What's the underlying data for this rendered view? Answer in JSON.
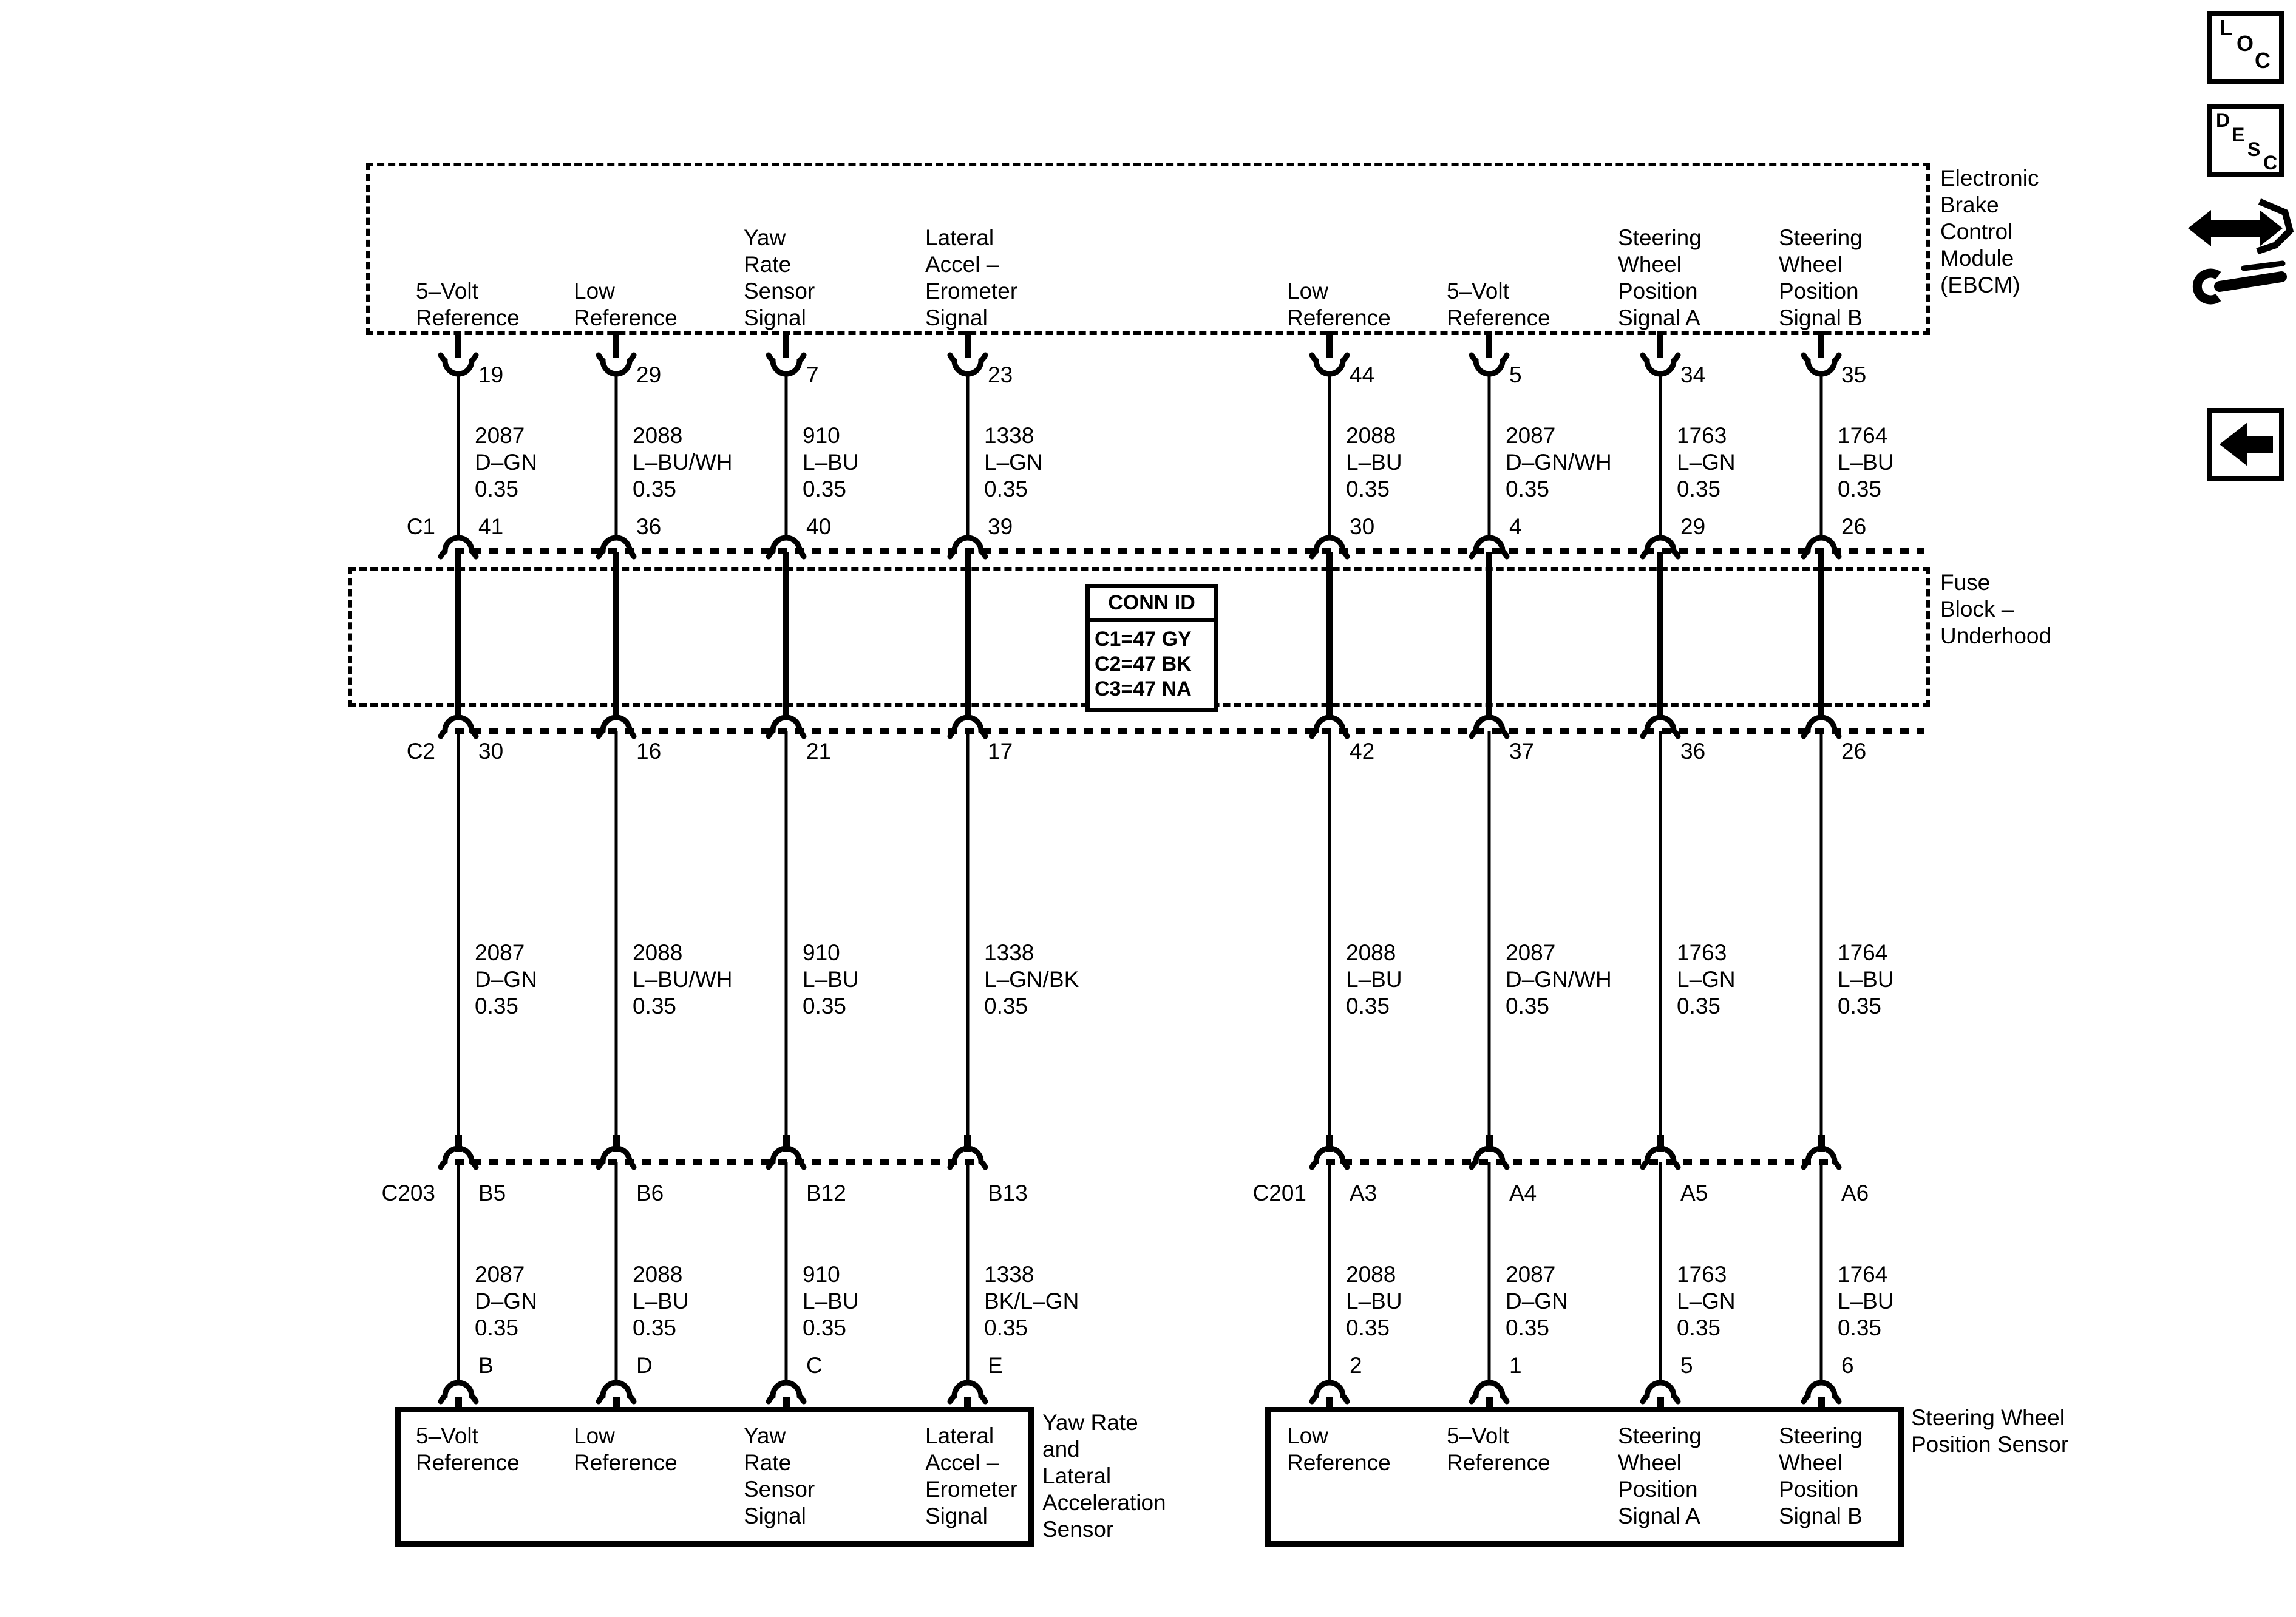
{
  "page": {
    "background": "#ffffff",
    "ink": "#000000"
  },
  "nav": {
    "loc_letters": [
      "L",
      "O",
      "C"
    ],
    "desc_letters": [
      "D",
      "E",
      "S",
      "C"
    ]
  },
  "ebcm": {
    "name": "Electronic\nBrake\nControl\nModule\n(EBCM)"
  },
  "fuse_block": {
    "name": "Fuse\nBlock –\nUnderhood",
    "conn_id_title": "CONN ID",
    "conn_id_rows": [
      "C1=47 GY",
      "C2=47 BK",
      "C3=47 NA"
    ]
  },
  "connectors": {
    "c1": "C1",
    "c2": "C2",
    "c203": "C203",
    "c201": "C201"
  },
  "sensors": {
    "yaw": "Yaw Rate\nand\nLateral\nAcceleration\nSensor",
    "swps": "Steering Wheel\nPosition Sensor"
  },
  "columns": [
    {
      "ebcm_signal": "5–Volt\nReference",
      "ebcm_pin": "19",
      "wire_top": "2087\nD–GN\n0.35",
      "c1_pin": "41",
      "c2_pin": "30",
      "wire_mid": "2087\nD–GN\n0.35",
      "branch_pin": "B5",
      "wire_bottom": "2087\nD–GN\n0.35",
      "device_pin": "B",
      "device_signal": "5–Volt\nReference"
    },
    {
      "ebcm_signal": "Low\nReference",
      "ebcm_pin": "29",
      "wire_top": "2088\nL–BU/WH\n0.35",
      "c1_pin": "36",
      "c2_pin": "16",
      "wire_mid": "2088\nL–BU/WH\n0.35",
      "branch_pin": "B6",
      "wire_bottom": "2088\nL–BU\n0.35",
      "device_pin": "D",
      "device_signal": "Low\nReference"
    },
    {
      "ebcm_signal": "Yaw\nRate\nSensor\nSignal",
      "ebcm_pin": "7",
      "wire_top": "910\nL–BU\n0.35",
      "c1_pin": "40",
      "c2_pin": "21",
      "wire_mid": "910\nL–BU\n0.35",
      "branch_pin": "B12",
      "wire_bottom": "910\nL–BU\n0.35",
      "device_pin": "C",
      "device_signal": "Yaw\nRate\nSensor\nSignal"
    },
    {
      "ebcm_signal": "Lateral\nAccel –\nErometer\nSignal",
      "ebcm_pin": "23",
      "wire_top": "1338\nL–GN\n0.35",
      "c1_pin": "39",
      "c2_pin": "17",
      "wire_mid": "1338\nL–GN/BK\n0.35",
      "branch_pin": "B13",
      "wire_bottom": "1338\nBK/L–GN\n0.35",
      "device_pin": "E",
      "device_signal": "Lateral\nAccel –\nErometer\nSignal"
    },
    {
      "ebcm_signal": "Low\nReference",
      "ebcm_pin": "44",
      "wire_top": "2088\nL–BU\n0.35",
      "c1_pin": "30",
      "c2_pin": "42",
      "wire_mid": "2088\nL–BU\n0.35",
      "branch_pin": "A3",
      "wire_bottom": "2088\nL–BU\n0.35",
      "device_pin": "2",
      "device_signal": "Low\nReference"
    },
    {
      "ebcm_signal": "5–Volt\nReference",
      "ebcm_pin": "5",
      "wire_top": "2087\nD–GN/WH\n0.35",
      "c1_pin": "4",
      "c2_pin": "37",
      "wire_mid": "2087\nD–GN/WH\n0.35",
      "branch_pin": "A4",
      "wire_bottom": "2087\nD–GN\n0.35",
      "device_pin": "1",
      "device_signal": "5–Volt\nReference"
    },
    {
      "ebcm_signal": "Steering\nWheel\nPosition\nSignal A",
      "ebcm_pin": "34",
      "wire_top": "1763\nL–GN\n0.35",
      "c1_pin": "29",
      "c2_pin": "36",
      "wire_mid": "1763\nL–GN\n0.35",
      "branch_pin": "A5",
      "wire_bottom": "1763\nL–GN\n0.35",
      "device_pin": "5",
      "device_signal": "Steering\nWheel\nPosition\nSignal A"
    },
    {
      "ebcm_signal": "Steering\nWheel\nPosition\nSignal B",
      "ebcm_pin": "35",
      "wire_top": "1764\nL–BU\n0.35",
      "c1_pin": "26",
      "c2_pin": "26",
      "wire_mid": "1764\nL–BU\n0.35",
      "branch_pin": "A6",
      "wire_bottom": "1764\nL–BU\n0.35",
      "device_pin": "6",
      "device_signal": "Steering\nWheel\nPosition\nSignal B"
    }
  ]
}
